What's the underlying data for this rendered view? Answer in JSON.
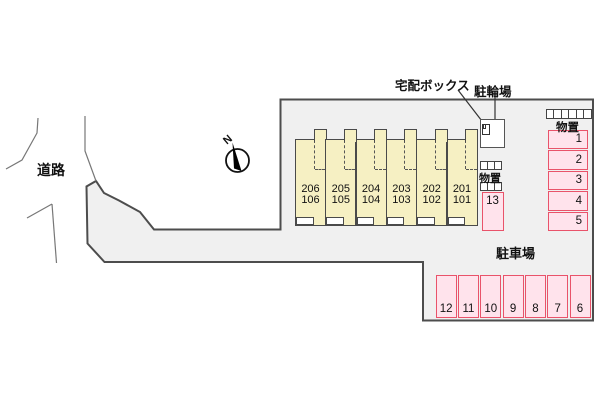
{
  "labels": {
    "road": "道路",
    "delivery_box": "宅配ボックス",
    "bicycle_parking": "駐輪場",
    "storage_center": "物置",
    "storage_right": "物置",
    "parking_lot": "駐車場",
    "north": "N"
  },
  "building": {
    "units": [
      {
        "upper": "206",
        "lower": "106"
      },
      {
        "upper": "205",
        "lower": "105"
      },
      {
        "upper": "204",
        "lower": "104"
      },
      {
        "upper": "203",
        "lower": "103"
      },
      {
        "upper": "202",
        "lower": "102"
      },
      {
        "upper": "201",
        "lower": "101"
      }
    ]
  },
  "parking": {
    "right_column": [
      "1",
      "2",
      "3",
      "4",
      "5"
    ],
    "middle_space": "13",
    "bottom_row": [
      "12",
      "11",
      "10",
      "9",
      "8",
      "7",
      "6"
    ]
  },
  "colors": {
    "site_fill": "#f0f0f0",
    "site_border": "#4d4d4d",
    "unit_fill": "#f6f0c3",
    "unit_border": "#4a4a4a",
    "parking_fill": "#ffe3ec",
    "parking_border": "#e9536a"
  }
}
